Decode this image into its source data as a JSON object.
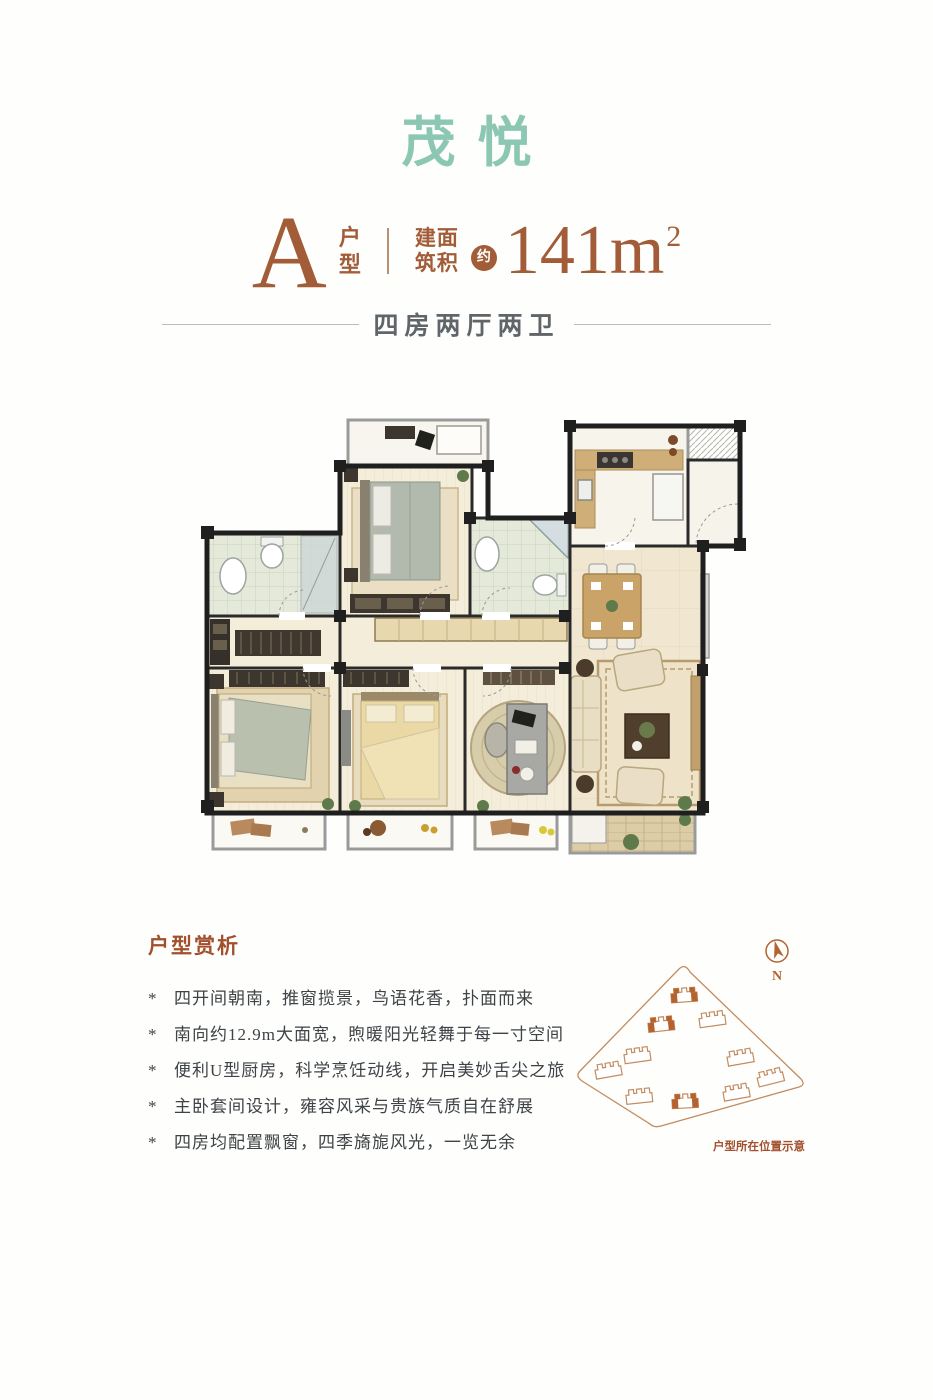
{
  "colors": {
    "title_teal": "#8cc7b4",
    "accent_brown": "#a25d38",
    "heading_brown": "#a2502c",
    "body_gray": "#3e4347",
    "layout_gray": "#5f6569",
    "siteplan_outline": "#c28c60",
    "siteplan_highlight": "#b5622f"
  },
  "header": {
    "project_name": "茂悦",
    "unit_letter": "A",
    "unit_label_rows": [
      "户",
      "型"
    ],
    "area_label_rows": [
      "建面",
      "筑积"
    ],
    "approx_badge": "约",
    "area_value": "141",
    "area_unit": "m",
    "area_exponent": "2"
  },
  "layout_line": {
    "text": "四房两厅两卫"
  },
  "floor_plan": {
    "depicted_rooms": [
      "balcony",
      "bedroom",
      "bathroom",
      "dressing-area",
      "master-bedroom",
      "bedroom",
      "study",
      "bathroom",
      "kitchen",
      "entry",
      "dining-area",
      "living-room",
      "bay-windows",
      "living-balcony"
    ]
  },
  "features": {
    "heading": "户型赏析",
    "bullet_char": "*",
    "items": [
      "四开间朝南，推窗揽景，鸟语花香，扑面而来",
      "南向约12.9m大面宽，煦暖阳光轻舞于每一寸空间",
      "便利U型厨房，科学烹饪动线，开启美妙舌尖之旅",
      "主卧套间设计，雍容风采与贵族气质自在舒展",
      "四房均配置飘窗，四季旖旎风光，一览无余"
    ]
  },
  "site_plan": {
    "compass_label": "N",
    "caption": "户型所在位置示意",
    "buildings": [
      {
        "x": 124,
        "y": 66,
        "rot": -4,
        "highlighted": true
      },
      {
        "x": 152,
        "y": 90,
        "rot": -8,
        "highlighted": false
      },
      {
        "x": 101,
        "y": 95,
        "rot": -6,
        "highlighted": true
      },
      {
        "x": 77,
        "y": 126,
        "rot": -8,
        "highlighted": false
      },
      {
        "x": 48,
        "y": 141,
        "rot": -10,
        "highlighted": false
      },
      {
        "x": 180,
        "y": 128,
        "rot": -10,
        "highlighted": false
      },
      {
        "x": 210,
        "y": 148,
        "rot": -14,
        "highlighted": false
      },
      {
        "x": 176,
        "y": 163,
        "rot": -10,
        "highlighted": false
      },
      {
        "x": 79,
        "y": 167,
        "rot": -6,
        "highlighted": false
      },
      {
        "x": 125,
        "y": 172,
        "rot": -3,
        "highlighted": true
      }
    ]
  }
}
